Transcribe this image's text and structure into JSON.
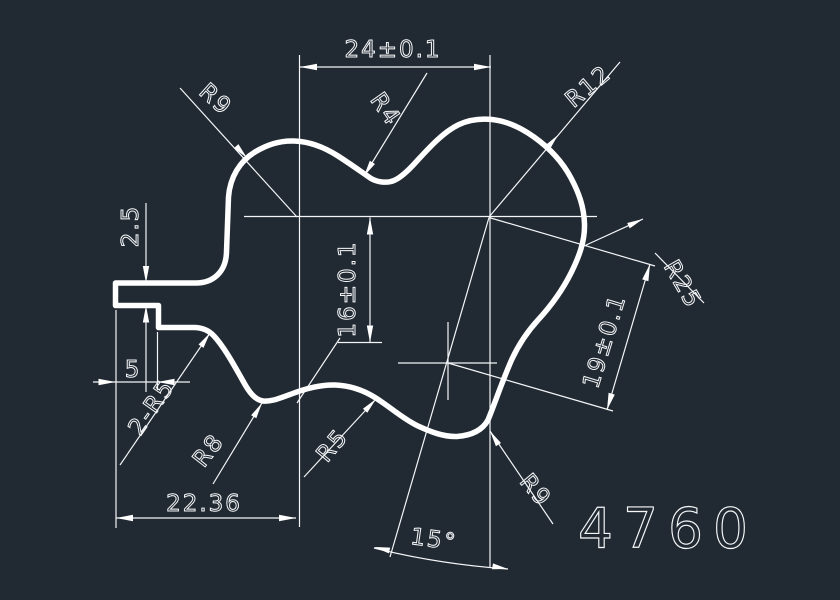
{
  "canvas": {
    "background_color": "#212932",
    "line_color": "#ffffff",
    "part_number": "4760"
  },
  "dimensions": {
    "top_width": "24±0.1",
    "mid_height": "16±0.1",
    "right_distance": "19±0.1",
    "tab_thickness": "2.5",
    "tab_depth": "5",
    "bottom_width": "22.36",
    "angle": "15°"
  },
  "radius_labels": {
    "top_left": "R9",
    "top_valley": "R4",
    "top_right": "R12",
    "right_side": "R25",
    "bottom_right": "R9",
    "notch_pair": "2-R5",
    "bottom_groove": "R8",
    "bottom_bump": "R5"
  }
}
